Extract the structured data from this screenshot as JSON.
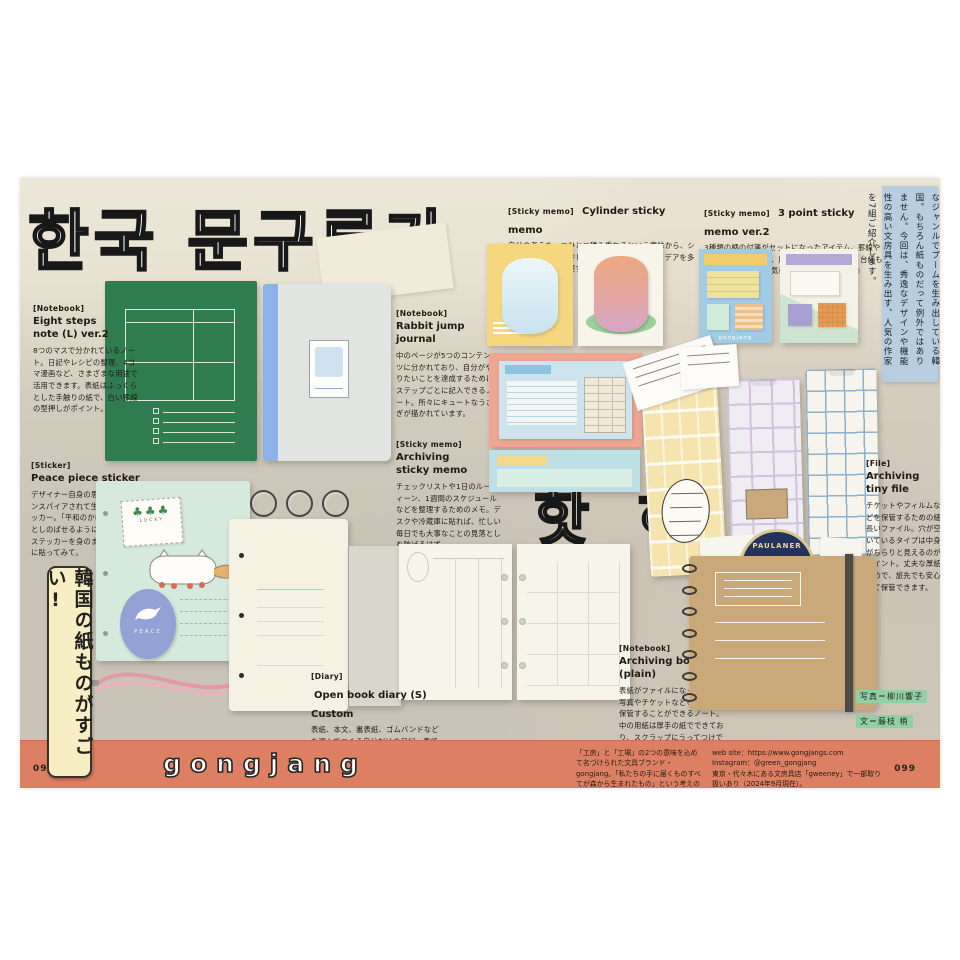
{
  "headline": {
    "korean": "한국 문구류가",
    "korean_hot": "핫 하 다 !"
  },
  "intro": {
    "text": "音楽やドラマ、ファッションなど、多様なジャンルでブームを生み出している韓国。もちろん紙ものだって例外ではありません。今回は、秀逸なデザインや機能性の高い文房具を生み出す、人気の作家を7組ご紹介します。"
  },
  "side_banner": {
    "text": "韓国の紙ものがすごい!"
  },
  "products": {
    "eight_steps": {
      "tag": "[Notebook]",
      "name": "Eight steps\nnote (L) ver.2",
      "desc": "8つのマスで分かれているノート。日記やレシピの整理、4コマ漫画など、さまざまな用途で活用できます。表紙はふっくらとした手触りの紙で、白い罫線の型押しがポイント。"
    },
    "rabbit": {
      "tag": "[Notebook]",
      "name": "Rabbit jump\njournal",
      "desc": "中のページが5つのコンテンツに分かれており、自分がやりたいことを達成するためにステップごとに記入できるノート。所々にキュートなうさぎが描かれています。"
    },
    "cylinder": {
      "tag": "[Sticky memo]",
      "name": "Cylinder sticky memo",
      "desc": "自分の考えを一つひとつ積み重ねるという意味から、シリンダーをイメージしてつくられた付箋。アイデアを多角的に見たり、整理するときに使ってみて。"
    },
    "three_point": {
      "tag": "[Sticky memo]",
      "name": "3 point sticky memo ver.2",
      "desc": "3種類の柄の付箋がセットになったアイテム。罫線や点が入っているので、用途に合わせて選んで。台紙もカラフルなので、お気に入りの色で選ぶのも◎",
      "brand_mark": "gongjang"
    },
    "archiving_memo": {
      "tag": "[Sticky memo]",
      "name": "Archiving\nsticky memo",
      "desc": "チェックリストや1日のルーティーン、1週間のスケジュールなどを整理するためのメモ。デスクや冷蔵庫に貼れば、忙しい毎日でも大事なことの見落としを防げるはず。"
    },
    "peace_sticker": {
      "tag": "[Sticker]",
      "name": "Peace piece sticker",
      "desc": "デザイナー自身の思い出からインスパイアされて生まれたステッカー。「平和のかけら」をそっとしのばせるように、愛らしいステッカーを身のまわりのものに貼ってみて。"
    },
    "open_diary": {
      "tag": "[Diary]",
      "name": "Open book diary (S) Custom",
      "desc": "表紙、本文、裏表紙、ゴムバンドなどを選んでつくる自分だけの日記。表紙に文字やイラストを描いたりシールを貼ったり、アレンジを加えることで唯一無二のアイテムに。"
    },
    "archiving_book": {
      "tag": "[Notebook]",
      "name": "Archiving book\n(plain)",
      "desc": "表紙がファイルになっており、写真やチケットなどをそのまま保管することができるノート。中の用紙は厚手の紙でできており、スクラップにうってつけです。"
    },
    "tiny_file": {
      "tag": "[File]",
      "name": "Archiving tiny file",
      "desc": "チケットやフィルムなどを保管するための細長いファイル。穴が空いているタイプは中身がちらりと見えるのがポイント。丈夫な厚紙なので、旅先でも安心して保管できます。"
    }
  },
  "stickers": {
    "clover_word": "LUCKY",
    "peace_word": "PEACE",
    "coaster_word": "PAULANER"
  },
  "credits": {
    "photo": "写真＝柳川響子",
    "text": "文＝藤枝 梢"
  },
  "footer": {
    "brand": "gongjang",
    "page_left": "098",
    "page_right": "099",
    "description": "「工房」と「工場」の2つの意味を込めて名づけられた文具ブランド・gongjang。「私たちの手に届くものすべてが森から生まれたもの」という考えのもと、持続可能な生産工程で自然を感じられる製品を生み出しています。",
    "web": "web site：https://www.gongjangs.com",
    "instagram": "Instagram：@green_gongjang",
    "shop_note": "東京・代々木にある文房具店「gweeney」で一部取り扱いあり（2024年9月現在）。"
  },
  "colors": {
    "footer_orange": "#dd7f62",
    "intro_blue": "#b6cedf",
    "banner_cream": "#f7eec5",
    "notebook_green": "#2e7c50",
    "journal_spine_blue": "#8bb3e8",
    "folder_mint": "#d6e9dd",
    "backing_salmon": "#eea591",
    "kraft_tan": "#c9a87a"
  }
}
